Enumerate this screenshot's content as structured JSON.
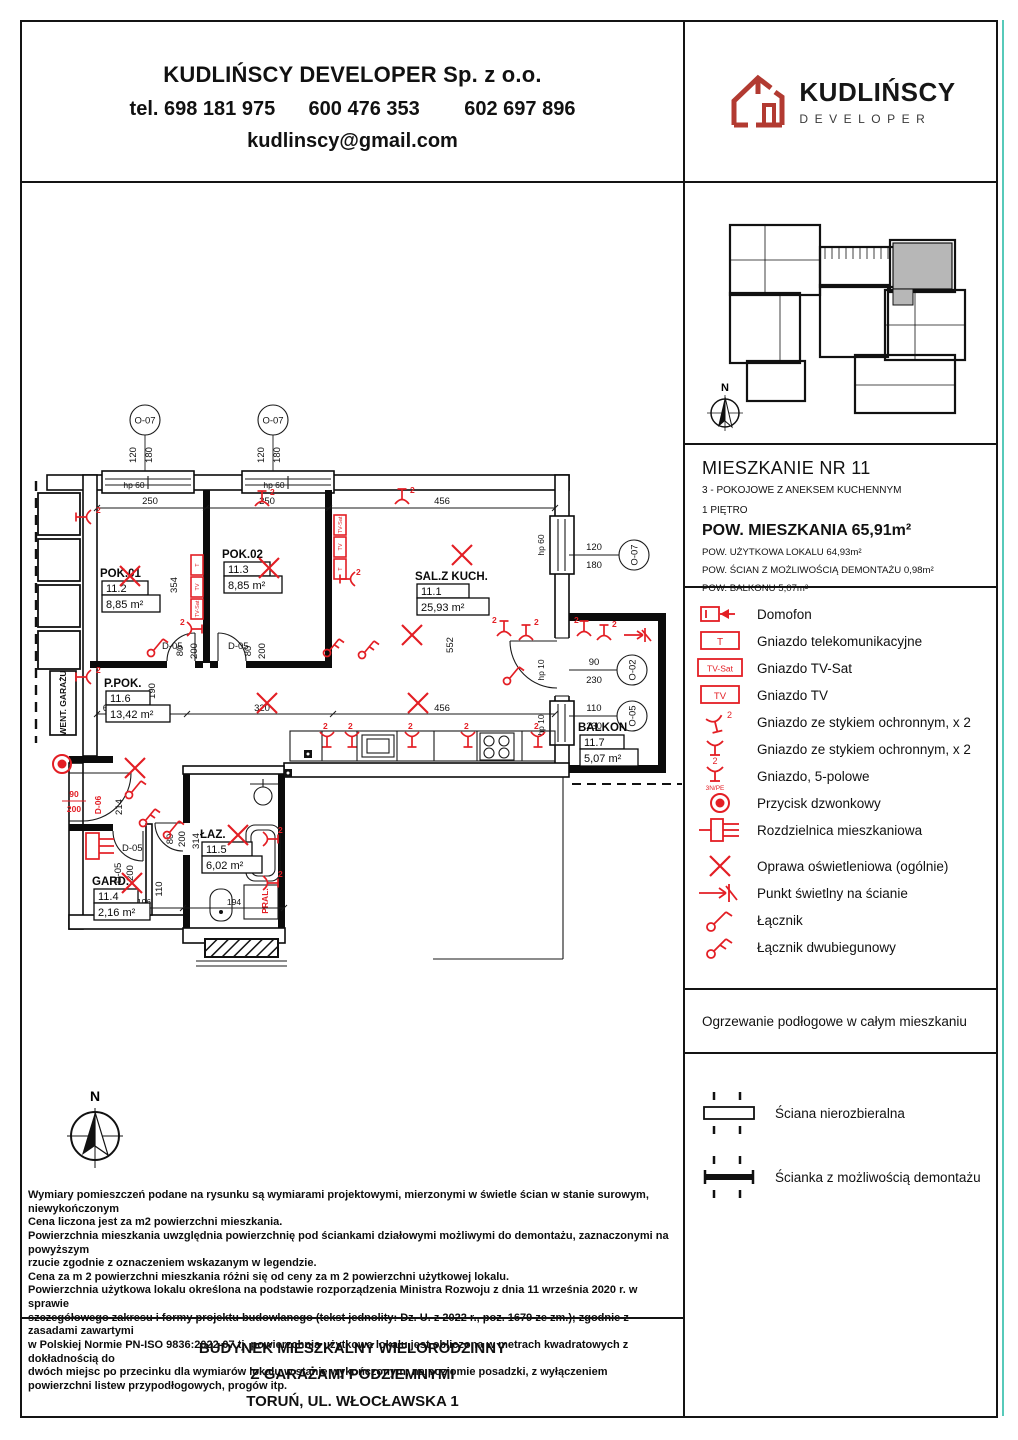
{
  "colors": {
    "accent_red": "#e31e24",
    "logo_red": "#b23a31",
    "teal_edge": "#45c4b3",
    "highlight_unit_gray": "#b7b7b7"
  },
  "header": {
    "company": "KUDLIŃSCY DEVELOPER Sp. z o.o.",
    "phones": "tel. 698 181 975      600 476 353        602 697 896",
    "email": "kudlinscy@gmail.com"
  },
  "logo": {
    "name": "KUDLIŃSCY",
    "subtitle": "DEVELOPER"
  },
  "overview": {
    "north": "N"
  },
  "apartment": {
    "title": "MIESZKANIE NR 11",
    "subtitle": "3 - POKOJOWE Z ANEKSEM KUCHENNYM",
    "floor": "1 PIĘTRO",
    "area_total": "POW. MIESZKANIA 65,91m²",
    "area_usable": "POW. UŻYTKOWA LOKALU 64,93m²",
    "area_walls": "POW. ŚCIAN Z MOŻLIWOŚCIĄ DEMONTAŻU 0,98m²",
    "area_balcony": "POW. BALKONU 5,07m²"
  },
  "legend": {
    "items": [
      {
        "label": "Domofon"
      },
      {
        "label": "Gniazdo telekomunikacyjne",
        "icon_text": "T"
      },
      {
        "label": "Gniazdo TV-Sat",
        "icon_text": "TV-Sat"
      },
      {
        "label": "Gniazdo TV",
        "icon_text": "TV"
      },
      {
        "label": "Gniazdo ze stykiem ochronnym, x 2",
        "icon_text": "2"
      },
      {
        "label": "Gniazdo ze stykiem ochronnym, x 2",
        "icon_text": "2"
      },
      {
        "label": "Gniazdo, 5-polowe",
        "icon_text": "3N/PE"
      },
      {
        "label": "Przycisk dzwonkowy"
      },
      {
        "label": "Rozdzielnica mieszkaniowa"
      },
      {
        "label": "Oprawa oświetleniowa (ogólnie)"
      },
      {
        "label": "Punkt świetlny na ścianie"
      },
      {
        "label": "Łącznik"
      },
      {
        "label": "Łącznik dwubiegunowy"
      }
    ]
  },
  "heating_note": "Ogrzewanie podłogowe w całym mieszkaniu",
  "walls_legend": {
    "solid": "Ściana nierozbieralna",
    "demountable": "Ścianka z możliwością demontażu"
  },
  "disclaimer": "Wymiary pomieszczeń podane na rysunku są wymiarami projektowymi, mierzonymi w świetle ścian w stanie surowym, niewykończonym\nCena liczona jest za m2 powierzchni mieszkania.\nPowierzchnia mieszkania uwzględnia powierzchnię pod ściankami działowymi możliwymi do demontażu, zaznaczonymi na powyższym\nrzucie zgodnie z oznaczeniem wskazanym w legendzie.\nCena za m 2 powierzchni mieszkania różni się od ceny za m 2 powierzchni użytkowej lokalu.\nPowierzchnia użytkowa lokalu określona na podstawie rozporządzenia Ministra Rozwoju z dnia 11 września 2020 r. w sprawie\nszczegółowego zakresu i formy projektu budowlanego (tekst jednolity: Dz. U. z 2022 r., poz. 1679 ze zm.); zgodnie z zasadami zawartymi\nw Polskiej Normie PN-ISO 9836:2022-07 tj. powierzchnia użytkowa lokalu jest obliczona w metrach kwadratowych z dokładnością do\ndwóch miejsc po przecinku dla wymiarów lokalu w stanie wykończonym, na poziomie posadzki, z wyłączeniem\npowierzchni listew przypodłogowych, progów itp.",
  "title_block": {
    "line1": "BUDYNEK MIESZKALNY WIELORODZINNY",
    "line2": "Z GARAŻAMI PODZIEMNYMI",
    "line3": "TORUŃ, UL. WŁOCŁAWSKA 1"
  },
  "plan": {
    "rooms": [
      {
        "name": "POK.01",
        "num": "11.2",
        "area": "8,85 m²"
      },
      {
        "name": "POK.02",
        "num": "11.3",
        "area": "8,85 m²"
      },
      {
        "name": "SAL.Z KUCH.",
        "num": "11.1",
        "area": "25,93 m²"
      },
      {
        "name": "P.POK.",
        "num": "11.6",
        "area": "13,42 m²"
      },
      {
        "name": "GARD.",
        "num": "11.4",
        "area": "2,16 m²"
      },
      {
        "name": "ŁAZ.",
        "num": "11.5",
        "area": "6,02 m²"
      },
      {
        "name": "BALKON",
        "num": "11.7",
        "area": "5,07 m²"
      }
    ],
    "dims": {
      "a250": "250",
      "a456": "456",
      "a552": "552",
      "a320": "320",
      "a136": "136",
      "a60": "60",
      "a190": "190",
      "a214": "214",
      "a314": "314",
      "a354": "354",
      "a196": "196",
      "a194": "194",
      "a110": "110",
      "a120": "120",
      "a180": "180",
      "a90": "90",
      "a230": "230"
    },
    "windows": {
      "hp60": "hp 60",
      "hp10": "hp 10"
    },
    "markers": {
      "o07": "O-07",
      "o02": "O-02",
      "o05": "O-05"
    },
    "doors": {
      "d05": "D-05",
      "d06": "D-06",
      "w80": "80",
      "w90": "90",
      "h200": "200"
    },
    "labels": {
      "went": "WENT. GARAŻU",
      "pral": "PRAL.",
      "north": "N",
      "two": "2",
      "t": "T",
      "tv": "TV",
      "tvsat": "TV-Sat"
    }
  }
}
